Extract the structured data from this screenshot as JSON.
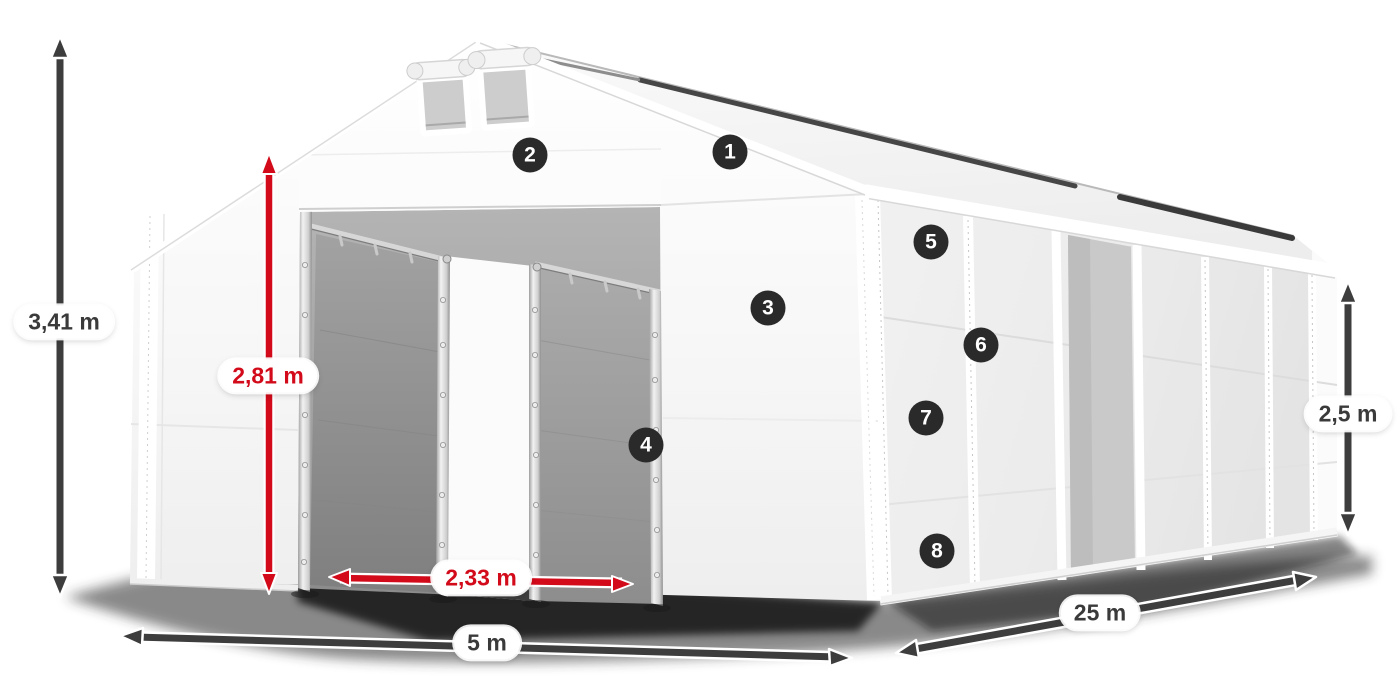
{
  "diagram": {
    "subject": "white storage tent with open entrance, dimension arrows and numbered feature markers",
    "measurements": {
      "total_height": "3,41 m",
      "entrance_height": "2,81 m",
      "entrance_width": "2,33 m",
      "width": "5 m",
      "length": "25 m",
      "side_height": "2,5 m"
    },
    "markers": [
      "1",
      "2",
      "3",
      "4",
      "5",
      "6",
      "7",
      "8"
    ],
    "colors": {
      "accent_red": "#d20a1a",
      "dimension_gray": "#3d3d3d",
      "marker_background": "#2a2a2a",
      "label_text": "#3a3a3a"
    }
  }
}
